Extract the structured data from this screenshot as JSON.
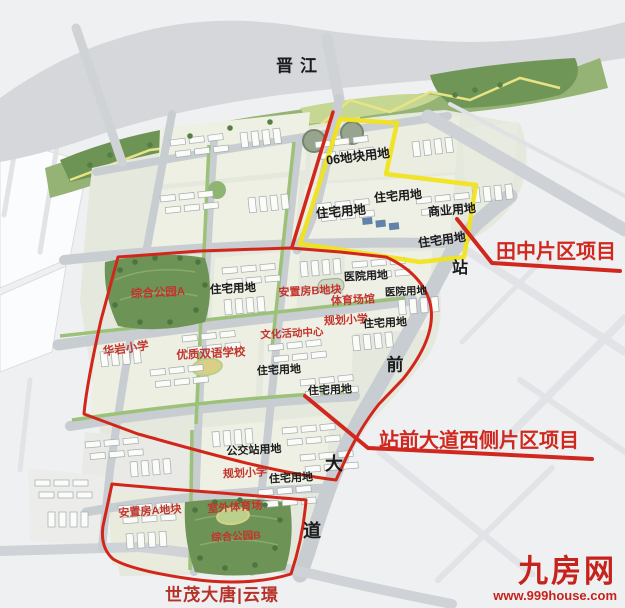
{
  "map_title_context": "master-plan rendering",
  "colors": {
    "boundary_red": "#d2261b",
    "boundary_yellow": "#f0e31f",
    "label_red": "#c2342c",
    "label_black": "#1b1b1b",
    "brand_red": "#c5231b",
    "park_green": "#6d9356",
    "road_grey": "#c8cdd2"
  },
  "map_labels": {
    "river": "晋江",
    "plot06": "06地块用地",
    "residential_1": "住宅用地",
    "residential_2": "住宅用地",
    "residential_3": "住宅用地",
    "residential_4": "住宅用地",
    "residential_5": "住宅用地",
    "residential_6": "住宅用地",
    "residential_7": "住宅用地",
    "residential_8": "住宅用地",
    "commercial": "商业用地",
    "hospital_1": "医院用地",
    "hospital_2": "医院用地",
    "park_a": "综合公园A",
    "park_b": "综合公园B",
    "resettlement_a": "安置房A地块",
    "resettlement_b": "安置房B地块",
    "sports_hall": "体育场馆",
    "planned_school_1": "规划小学",
    "planned_school_2": "规划小学",
    "culture_center": "文化活动中心",
    "huayan_school": "华岩小学",
    "bilingual_school": "优质双语学校",
    "bus_station": "公交站用地",
    "outdoor_stadium": "室外体育场"
  },
  "road_name": {
    "char_1": "站",
    "char_2": "前",
    "char_3": "大",
    "char_4": "道"
  },
  "callouts": {
    "tianzhong": "田中片区项目",
    "zhanqian_west": "站前大道西侧片区项目"
  },
  "footer": {
    "project_name": "世茂大唐|云璟"
  },
  "watermark": {
    "site_name": "九房网",
    "site_url": "www.999house.com"
  }
}
